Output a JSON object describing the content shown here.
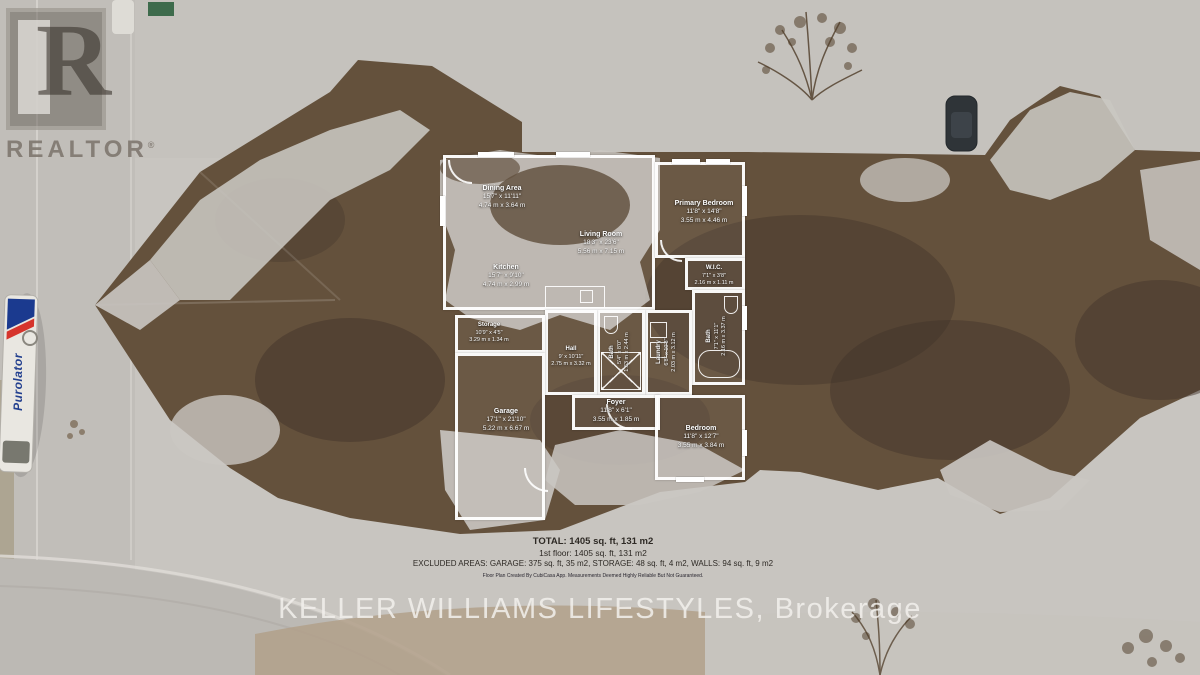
{
  "watermark": {
    "brand": "REALTOR",
    "registered": "®",
    "logo_letter": "R"
  },
  "truck": {
    "brand": "Purolator"
  },
  "floorplan": {
    "rooms": [
      {
        "name": "Dining Area",
        "imperial": "15'7\" x 11'11\"",
        "metric": "4.74 m x 3.64 m"
      },
      {
        "name": "Living Room",
        "imperial": "18'3\" x 23'6\"",
        "metric": "5.56 m x 7.15 m"
      },
      {
        "name": "Primary Bedroom",
        "imperial": "11'8\" x 14'8\"",
        "metric": "3.55 m x 4.46 m"
      },
      {
        "name": "Kitchen",
        "imperial": "15'7\" x 9'10\"",
        "metric": "4.74 m x 2.99 m"
      },
      {
        "name": "W.I.C.",
        "imperial": "7'1\" x 3'8\"",
        "metric": "2.16 m x 1.11 m"
      },
      {
        "name": "Storage",
        "imperial": "10'9\" x 4'5\"",
        "metric": "3.29 m x 1.34 m"
      },
      {
        "name": "Hall",
        "imperial": "9' x 10'11\"",
        "metric": "2.75 m x 3.32 m"
      },
      {
        "name": "Bath",
        "imperial": "5'4\" x 8'0\"",
        "metric": "1.63 m x 2.44 m"
      },
      {
        "name": "Laundry",
        "imperial": "6'8\" x 10'3\"",
        "metric": "2.03 m x 3.12 m"
      },
      {
        "name": "Bath",
        "imperial": "7'1\" x 11'1\"",
        "metric": "2.16 m x 3.37 m"
      },
      {
        "name": "Garage",
        "imperial": "17'1\" x 21'10\"",
        "metric": "5.22 m x 6.67 m"
      },
      {
        "name": "Foyer",
        "imperial": "11'8\" x 6'1\"",
        "metric": "3.55 m x 1.85 m"
      },
      {
        "name": "Bedroom",
        "imperial": "11'8\" x 12'7\"",
        "metric": "3.55 m x 3.84 m"
      }
    ],
    "summary": {
      "total": "TOTAL: 1405 sq. ft, 131 m2",
      "first_floor": "1st floor: 1405 sq. ft, 131 m2",
      "excluded": "EXCLUDED AREAS: GARAGE: 375 sq. ft, 35 m2, STORAGE: 48 sq. ft, 4 m2, WALLS: 94 sq. ft, 9 m2",
      "disclaimer": "Floor Plan Created By CubiCasa App. Measurements Deemed Highly Reliable But Not Guaranteed."
    }
  },
  "footer": {
    "brokerage": "KELLER WILLIAMS LIFESTYLES, Brokerage"
  },
  "colors": {
    "roof_brown": "#64513c",
    "snow": "#c9c6c1",
    "plan_line": "#ffffff",
    "summary_text": "#2e2a25",
    "brokerage_text": "#f0eeeb",
    "purolator_blue": "#23408f"
  }
}
